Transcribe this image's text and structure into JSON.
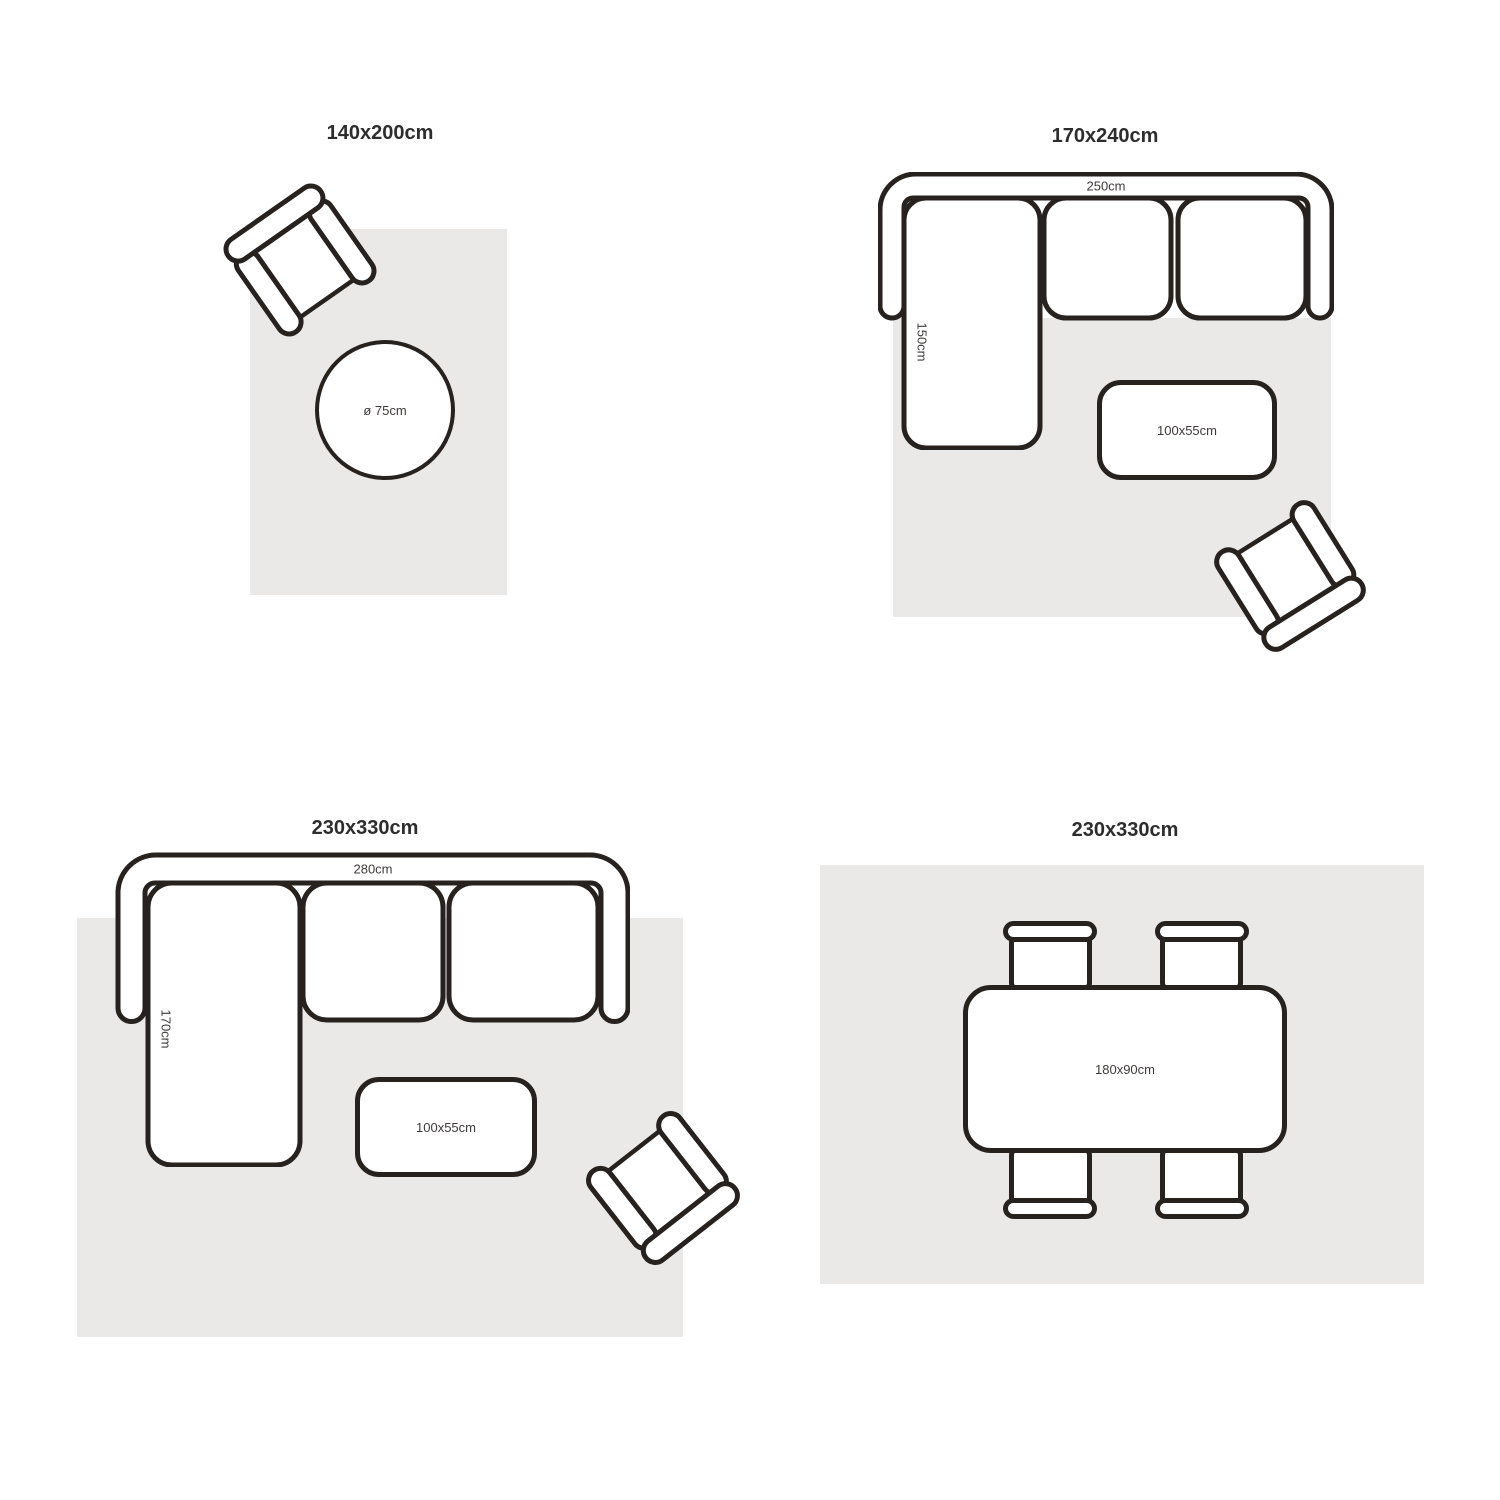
{
  "colors": {
    "background": "#ffffff",
    "rug": "#eae9e7",
    "stroke": "#28221f",
    "title_text": "#2d2d2d",
    "label_text": "#3e3a39"
  },
  "armchair": {
    "back_label": "73cm",
    "arm_label": "74cm"
  },
  "quadrants": {
    "top_left": {
      "title": "140x200cm",
      "round_table_label": "ø 75cm"
    },
    "top_right": {
      "title": "170x240cm",
      "sofa_width_label": "250cm",
      "chaise_label": "150cm",
      "coffee_table_label": "100x55cm"
    },
    "bottom_left": {
      "title": "230x330cm",
      "sofa_width_label": "280cm",
      "chaise_label": "170cm",
      "coffee_table_label": "100x55cm"
    },
    "bottom_right": {
      "title": "230x330cm",
      "dining_table_label": "180x90cm"
    }
  }
}
